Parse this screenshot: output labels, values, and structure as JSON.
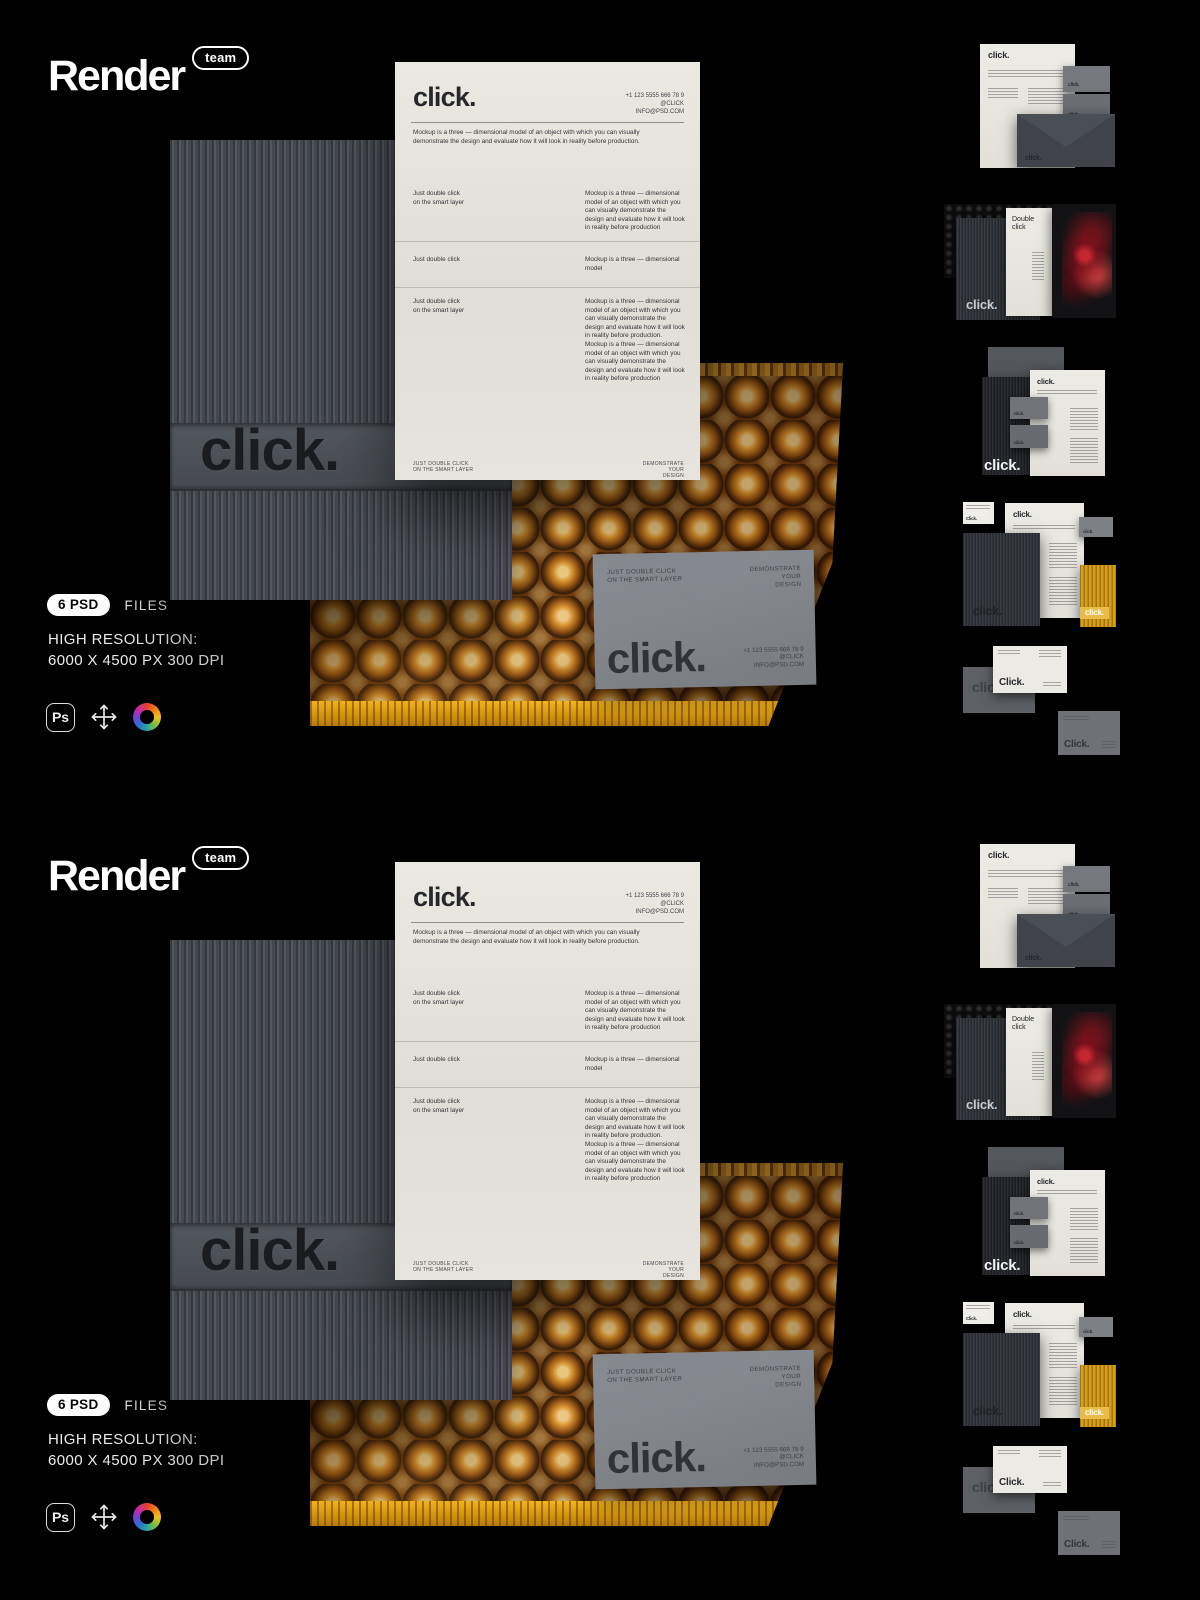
{
  "brand": {
    "name": "Render",
    "badge": "team"
  },
  "colors": {
    "background": "#000000",
    "paper": "#e7e5de",
    "folder_gray": "#4a4e54",
    "mailer_gold": "#c4851b",
    "mailer_strip": "#e0a012",
    "card_gray": "#84878c",
    "accent_yellow": "#d4a01f",
    "text_light": "#ececec"
  },
  "panel": {
    "letterhead": {
      "logo": "click.",
      "contact": "+1 123 5555 666 78 9\n@CLICK\nINFO@PSD.COM",
      "intro": "Mockup is a three — dimensional model of an object with which you can visually demonstrate the design and evaluate how it will look in reality before production.",
      "row1_left": "Just double click\non the smart layer",
      "row1_right": "Mockup is a three — dimensional model of an object with which you can visually demonstrate the design and evaluate how it will look in reality before production",
      "row2_left": "Just double click",
      "row2_right": "Mockup is a three — dimensional model",
      "row3_left": "Just double click\non the smart layer",
      "row3_right": "Mockup is a three — dimensional model of an object with which you can visually demonstrate the design and evaluate how it will look in reality before production. Mockup is a three — dimensional model of an object with which you can visually demonstrate the design and evaluate how it will look in reality before production",
      "footer_left": "JUST DOUBLE CLICK\nON THE SMART LAYER",
      "footer_right": "DEMONSTRATE\nYOUR\nDESIGN"
    },
    "folder": {
      "emboss": "click."
    },
    "card": {
      "top_left": "JUST DOUBLE CLICK\nON THE SMART LAYER",
      "top_right": "DEMONSTRATE\nYOUR\nDESIGN",
      "logo": "click.",
      "contact": "+1 123 5555 666 78 9\n@CLICK\nINFO@PSD.COM"
    },
    "info": {
      "badge": "6 PSD",
      "files": "FILES",
      "res_line1": "HIGH RESOLUTION:",
      "res_line2": "6000 X 4500 PX 300 DPI",
      "ps_label": "Ps",
      "icon_names": [
        "photoshop-icon",
        "move-icon",
        "color-wheel-icon"
      ]
    },
    "thumbs": {
      "t1": {
        "letter_logo": "click.",
        "card1": "click.",
        "card2": "click.",
        "envelope": "click."
      },
      "t2": {
        "folder": "click.",
        "brochure_title": "Double click"
      },
      "t3": {
        "letter_logo": "click.",
        "card1": "click.",
        "card2": "click.",
        "caption": "click."
      },
      "t4": {
        "minicard": "Click.",
        "letter_logo": "click.",
        "graycard": "click.",
        "folder": "click.",
        "yellowcard": "click."
      },
      "t5": {
        "card1": "click.",
        "card2": "Click.",
        "card3": "Click."
      }
    }
  }
}
